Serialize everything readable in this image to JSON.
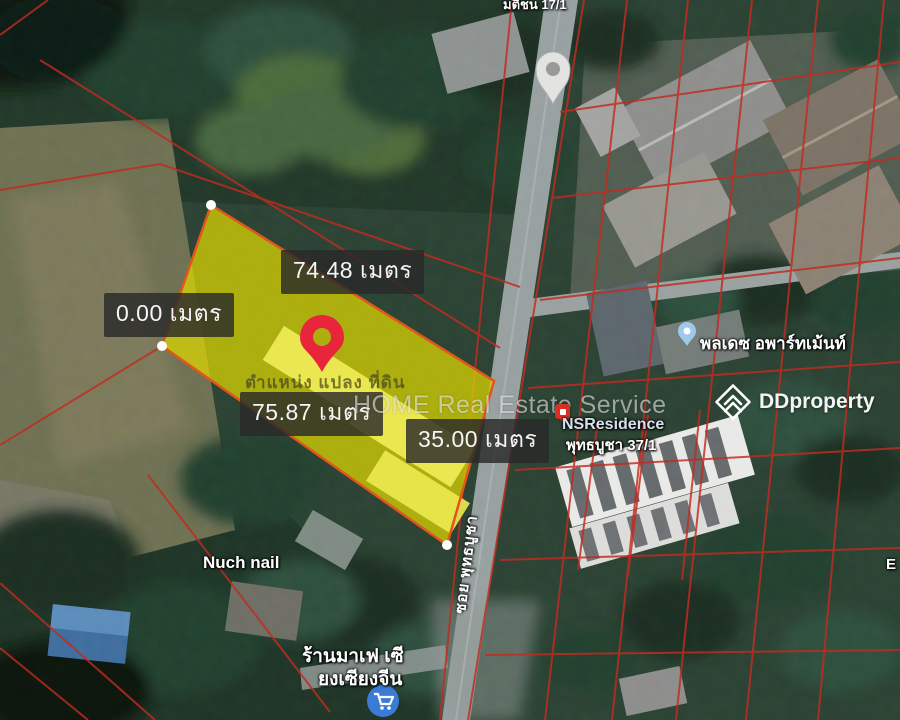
{
  "measurements": {
    "top_edge": "74.48 เมตร",
    "left_edge": "0.00 เมตร",
    "bottom_edge": "75.87 เมตร",
    "right_edge": "35.00 เมตร"
  },
  "plot": {
    "caption": "ตำแหน่ง แปลง ที่ดิน",
    "fill_color": "#ded800",
    "outline_color": "#e2561c"
  },
  "watermarks": {
    "center_text": "HOME Real Estate Service",
    "brand_text": "DDproperty"
  },
  "place_labels": {
    "top_partial": "มติชน 17/1",
    "nuch_nail": "Nuch nail",
    "apartment": "พลเดซ อพาร์ทเม้นท์",
    "nsresidence_name": "NSResidence",
    "nsresidence_address": "พุทธบูชา 37/1",
    "road_name": "ซอย พุทธบูชา",
    "restaurant_line1": "ร้านมาเฟ เซี",
    "restaurant_line2": "ยงเซียงจีน",
    "right_edge_partial": "E"
  },
  "colors": {
    "cadastral_line": "#c22b20",
    "pin_red": "#e8253a",
    "measure_label_bg": "#2a2a2a",
    "measure_label_text": "#f5f5f5"
  }
}
